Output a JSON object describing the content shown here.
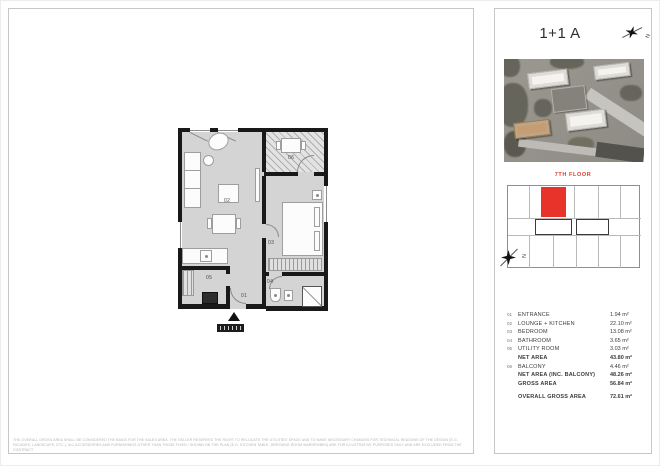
{
  "header": {
    "title": "1+1 A",
    "compass": "N"
  },
  "key_plan": {
    "floor_label": "7TH FLOOR",
    "compass": "N"
  },
  "floor_plan": {
    "rooms": {
      "entrance": "01",
      "lounge_kitchen": "02",
      "bedroom": "03",
      "bathroom": "04",
      "utility": "05",
      "balcony": "06"
    }
  },
  "area_table": {
    "rows": [
      {
        "num": "01",
        "label": "ENTRANCE",
        "value": "1.94 m²"
      },
      {
        "num": "02",
        "label": "LOUNGE + KITCHEN",
        "value": "22.10 m²"
      },
      {
        "num": "03",
        "label": "BEDROOM",
        "value": "13.08 m²"
      },
      {
        "num": "04",
        "label": "BATHROOM",
        "value": "3.65 m²"
      },
      {
        "num": "05",
        "label": "UTILITY ROOM",
        "value": "3.03 m²"
      },
      {
        "num": "",
        "label": "NET AREA",
        "value": "43.80 m²"
      },
      {
        "num": "06",
        "label": "BALCONY",
        "value": "4.46 m²"
      },
      {
        "num": "",
        "label": "NET AREA (INC. BALCONY)",
        "value": "48.26 m²"
      },
      {
        "num": "",
        "label": "GROSS AREA",
        "value": "56.84 m²"
      },
      {
        "num": "",
        "label": "OVERALL GROSS AREA",
        "value": "72.61 m²"
      }
    ]
  },
  "disclaimer": {
    "line1": "THE OVERALL GROSS AREA SHALL BE CONSIDERED THE BASIS FOR THE SALES AREA. THE SELLER RESERVES THE RIGHT TO RELOCATE THE UTILITIES' SPACE AND TO MAKE NECESSARY CHANGES FOR TECHNICAL REASONS OF THE DESIGN (E.G.",
    "line2": "FACADES, LANDSCAPE, ETC.). ALL ACCESSORIES AND FURNISHINGS OTHER THAN THOSE FIXED / SHOWN ON THE PLAN (E.G. KITCHEN TABLE, DRESSING ROOM WARDROBES) ARE FOR ILLUSTRATIVE PURPOSES ONLY AND ARE EXCLUDED FROM THE CONTRACT."
  },
  "colors": {
    "accent_red": "#e8332b",
    "wall": "#191919",
    "floor": "#d4d4d4"
  }
}
